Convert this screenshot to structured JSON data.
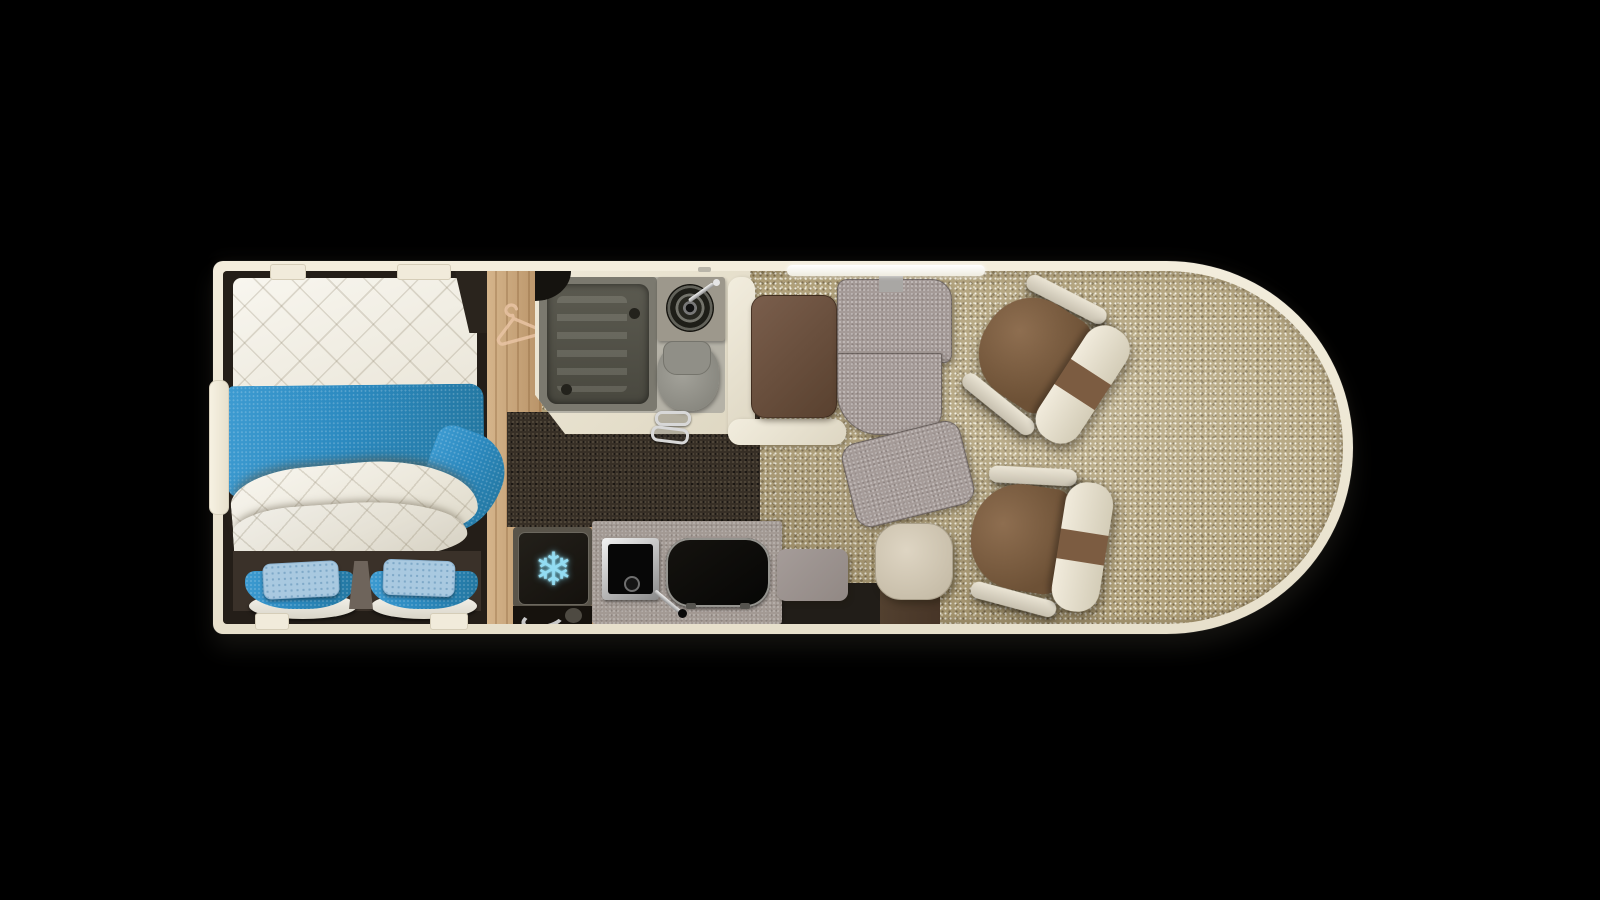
{
  "scene": {
    "type": "motorhome-floorplan-top-view",
    "background_color": "#000000",
    "fridge_icon_glyph": "❄"
  },
  "palette": {
    "outer_wall": "#ece5d3",
    "inner_wall_dark": "#241e18",
    "carpet": "#af9f78",
    "dark_floor": "#372f26",
    "wood_floor": "#c7a276",
    "mattress_white": "#f1eee6",
    "bed_runner_blue": "#2c8bc1",
    "pillow_blue": "#a9c9e0",
    "fabric_gray": "#a59b98",
    "bench_cream": "#ece7d8",
    "table_brown": "#6b5140",
    "stool_beige": "#cfc5b1",
    "counter_gray": "#a39a94",
    "chair_brown": "#7c5c41",
    "chair_cream": "#ece4d4",
    "snowflake_blue": "#93dcf2",
    "hanger_peach": "#e9c4a4",
    "chrome": "#d9dadb"
  },
  "rooms": {
    "bedroom": {
      "fixtures": [
        "double-bed",
        "bed-runner",
        "rear-seat-left",
        "rear-seat-right",
        "pillow-left",
        "pillow-right"
      ]
    },
    "wardrobe": {
      "fixtures": [
        "hanger-icon"
      ]
    },
    "bathroom": {
      "fixtures": [
        "shower-tray",
        "washbasin",
        "toilet",
        "door-handle"
      ]
    },
    "kitchen": {
      "fixtures": [
        "fridge",
        "snowflake-icon",
        "kitchen-sink",
        "hob",
        "worktop"
      ]
    },
    "dinette": {
      "fixtures": [
        "table",
        "bench-seat",
        "swivel-bench",
        "stool"
      ]
    },
    "cab": {
      "fixtures": [
        "pilot-seat-left",
        "pilot-seat-right",
        "cab-carpet"
      ]
    }
  }
}
